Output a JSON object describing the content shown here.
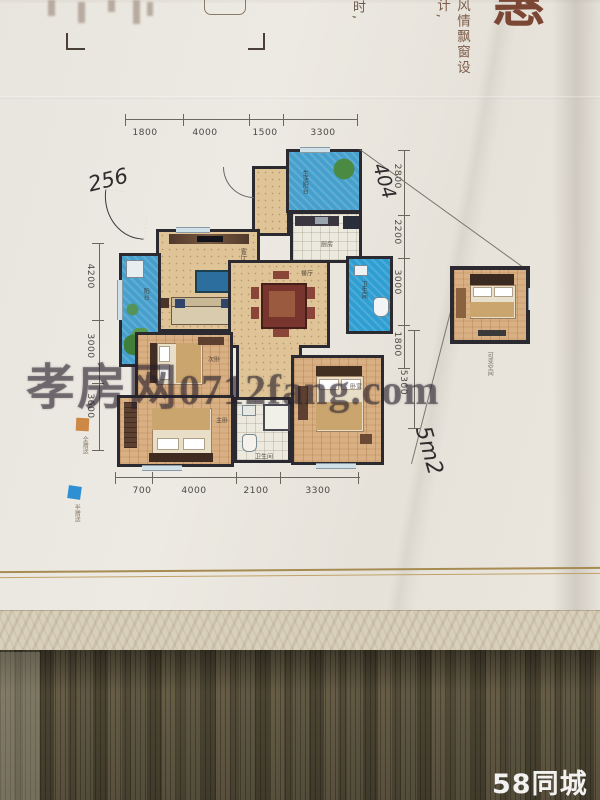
{
  "photo": {
    "header": {
      "big_char_partial": "惠",
      "vertical_text_1": "风情飘窗设计,",
      "vertical_text_2": "时,"
    },
    "floorplan": {
      "dims_top": [
        "1800",
        "4000",
        "1500",
        "3300"
      ],
      "dims_left": [
        "4200",
        "3000",
        "3600"
      ],
      "dims_right": [
        "2800",
        "2200",
        "3000",
        "1800",
        "5300"
      ],
      "dims_bottom": [
        "700",
        "4000",
        "2100",
        "3300"
      ],
      "rooms": {
        "living": "客厅",
        "dining": "餐厅",
        "kitchen": "厨房",
        "bath1": "卫生间",
        "bath2": "卫生间",
        "master": "主卧",
        "bed2": "次卧",
        "bed3": "卧室",
        "balcony": "阳台",
        "service_balcony": "生活阳台",
        "flex_space": "可变空间"
      },
      "legend": {
        "full_gift": "全赠送",
        "half_gift": "半赠送"
      },
      "colors": {
        "wall_dark": "#2a2a30",
        "balcony_blue": "#46a0cd",
        "bath_blue": "#2f9ed2",
        "floor_tan": "#dfc497",
        "legend_orange": "#cd8845",
        "legend_blue": "#2e8fd2"
      }
    },
    "handwritten": {
      "note_left": "256",
      "note_right": "404",
      "note_area": "5m2"
    },
    "watermark": {
      "site_name": "孝房网",
      "site_url": "0712fang.com"
    },
    "platform_logo": "58同城"
  }
}
